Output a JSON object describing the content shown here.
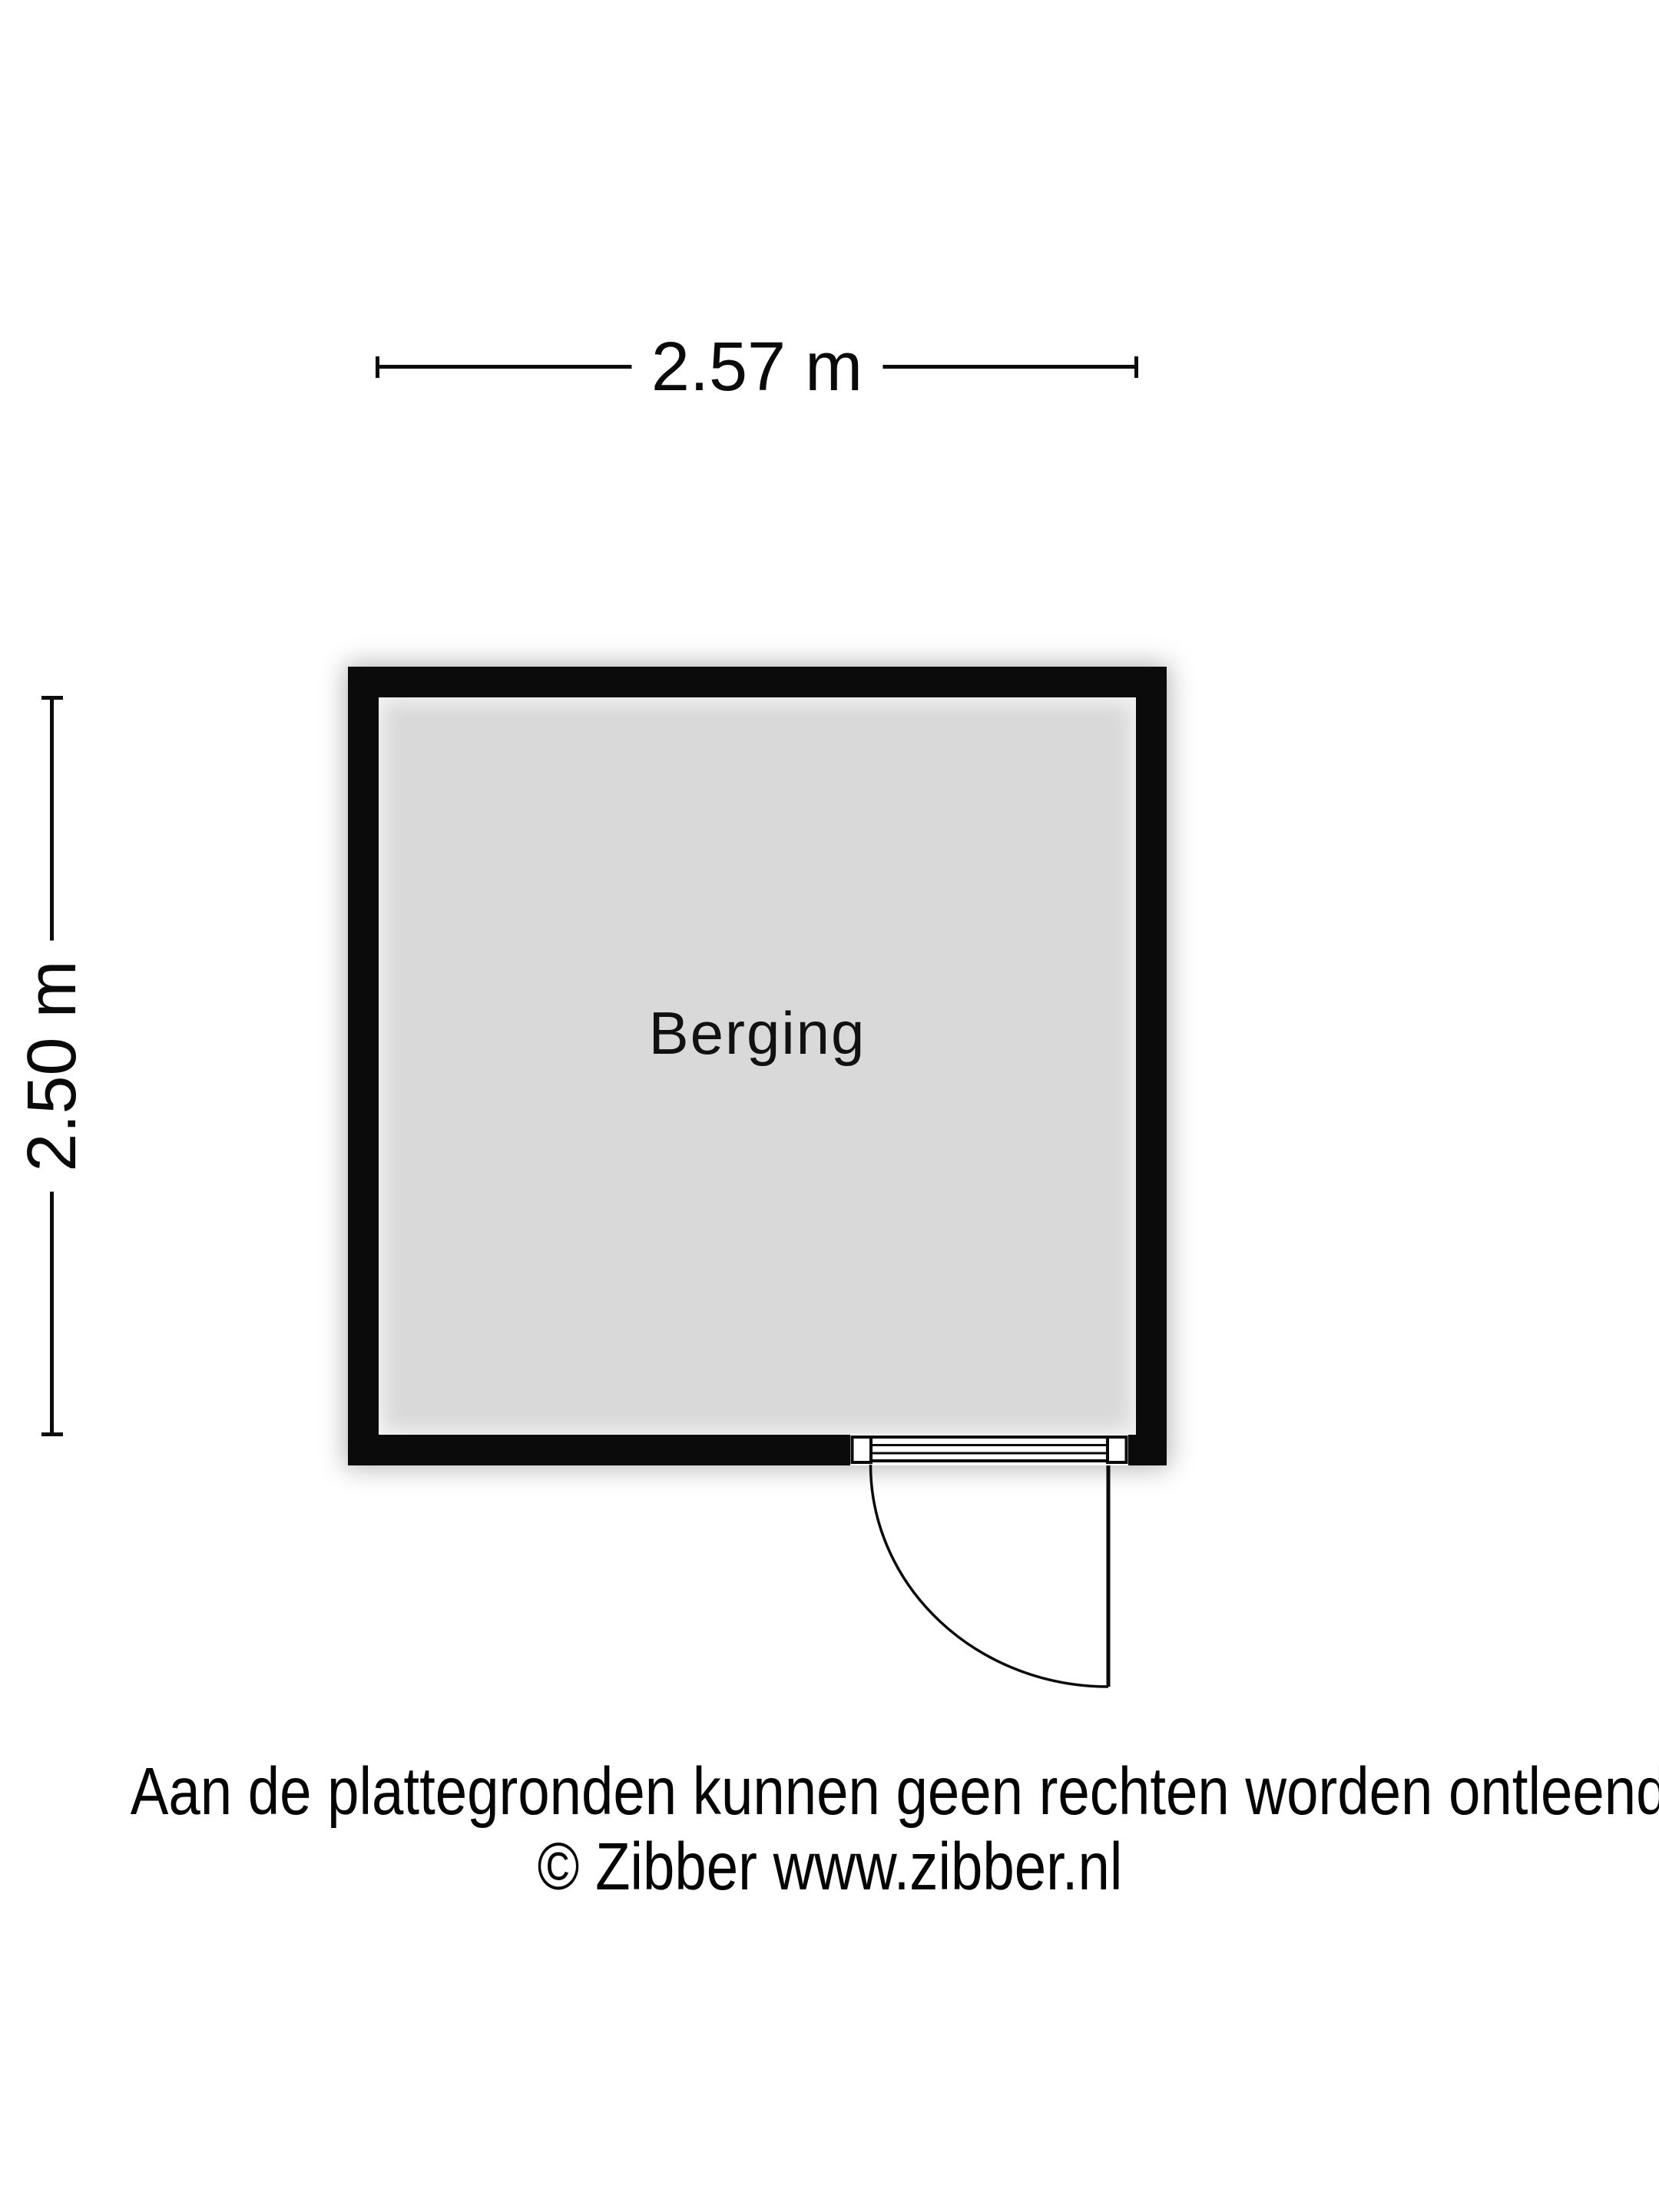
{
  "floorplan": {
    "room": {
      "label": "Berging"
    },
    "dimensions": {
      "width_label": "2.57 m",
      "depth_label": "2.50 m"
    },
    "colors": {
      "wall": "#0b0b0b",
      "floor": "#d9d9d9",
      "background": "#ffffff",
      "line": "#0c0c0c"
    }
  },
  "footer": {
    "disclaimer": "Aan de plattegronden kunnen geen rechten worden ontleend",
    "credit": "© Zibber www.zibber.nl"
  }
}
